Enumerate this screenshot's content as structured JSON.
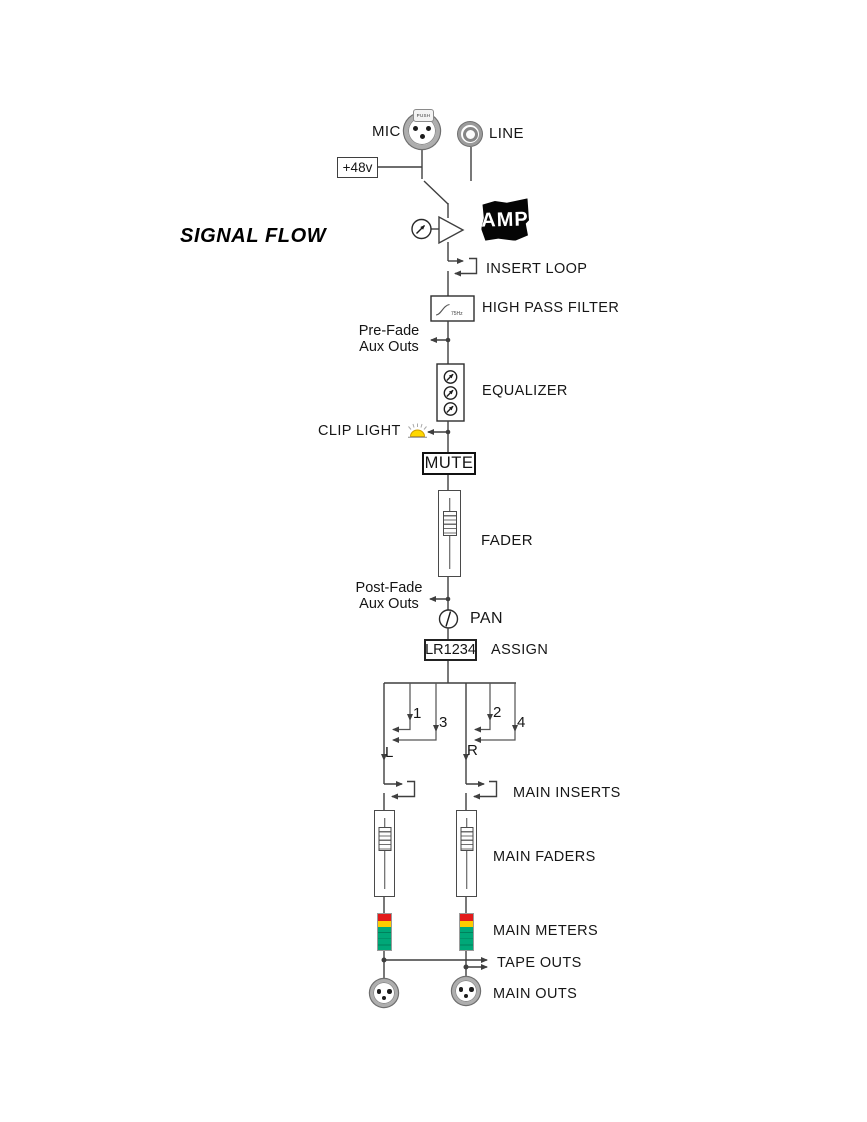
{
  "title": "SIGNAL FLOW",
  "inputs": {
    "mic_label": "MIC",
    "line_label": "LINE",
    "phantom_label": "+48v",
    "xlr_tab_label": "PUSH"
  },
  "preamp": {
    "amp_stamp": "AMP"
  },
  "channel": {
    "insert_loop": "INSERT LOOP",
    "high_pass_filter": "HIGH PASS FILTER",
    "hpf_freq": "75Hz",
    "pre_fade_line1": "Pre-Fade",
    "pre_fade_line2": "Aux Outs",
    "equalizer": "EQUALIZER",
    "clip_light": "CLIP LIGHT",
    "mute": "MUTE",
    "fader": "FADER",
    "post_fade_line1": "Post-Fade",
    "post_fade_line2": "Aux Outs",
    "pan": "PAN",
    "assign_value": "LR1234",
    "assign_label": "ASSIGN"
  },
  "routing": {
    "bus1": "1",
    "bus2": "2",
    "bus3": "3",
    "bus4": "4",
    "left": "L",
    "right": "R"
  },
  "master": {
    "main_inserts": "MAIN INSERTS",
    "main_faders": "MAIN FADERS",
    "main_meters": "MAIN METERS",
    "tape_outs": "TAPE OUTS",
    "main_outs": "MAIN OUTS"
  },
  "icons": {
    "mic_connector": "xlr-female-socket",
    "line_connector": "quarter-inch-jack-socket",
    "preamp": "amplifier-triangle",
    "gain_control": "knob-with-arrow",
    "eq_band_control": "knob-with-arrow",
    "clip_indicator": "yellow-warning-lamp",
    "pan_control": "knob",
    "main_out_connector": "xlr-male-socket"
  },
  "colors": {
    "wire": "#3f3f3f",
    "meter_red": "#e31a1a",
    "meter_yellow": "#ffcc00",
    "meter_green": "#00a878",
    "clip_yellow": "#ffd800"
  }
}
